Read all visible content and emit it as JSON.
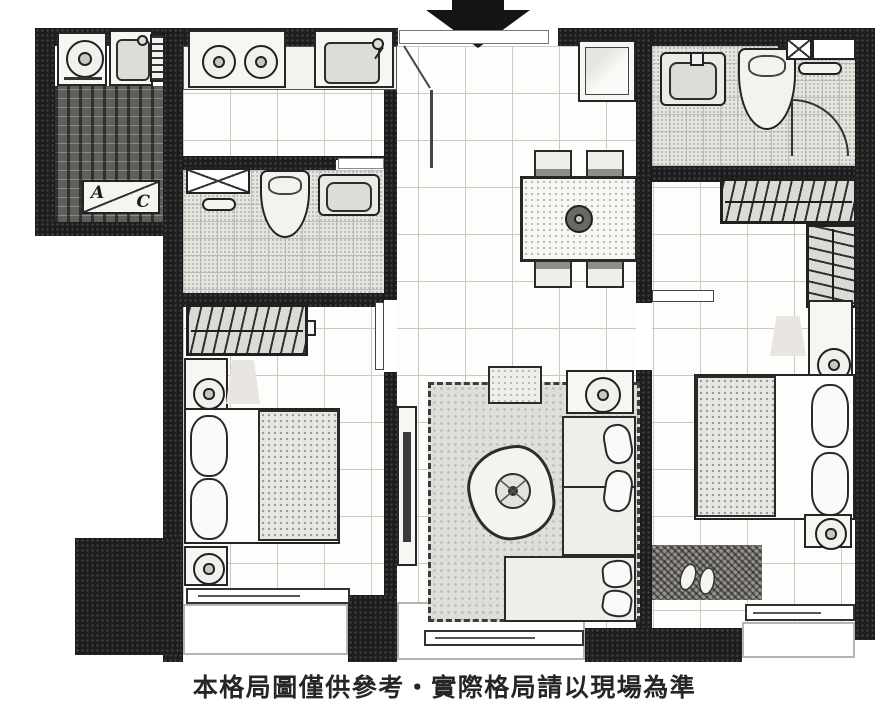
{
  "meta": {
    "type": "apartment-floor-plan",
    "disclaimer": "本格局圖僅供參考‧實際格局請以現場為準"
  },
  "labels": {
    "ac_a": "A",
    "ac_c": "C"
  },
  "entrance": {
    "marker": "arrow-down"
  },
  "colors": {
    "wall": "#1d1d1d",
    "floor_line": "#cbc9c4",
    "bath_tile": "#e6e4df",
    "dark_tile": "#605e5b",
    "furniture_fill": "#f7f6f3",
    "outline": "#262626"
  },
  "rooms": [
    "utility-porch",
    "ac-balcony",
    "kitchen",
    "entry-hall",
    "front-bathroom",
    "master-bathroom",
    "dining-area",
    "living-room",
    "left-bedroom",
    "right-bedroom",
    "left-balcony",
    "center-balcony",
    "right-balcony"
  ],
  "furniture": [
    "washing-machine",
    "utility-sink",
    "louver-rack",
    "gas-stove",
    "kitchen-sink",
    "refrigerator",
    "wash-basin-front",
    "toilet-front",
    "shower-door",
    "towel-shelf",
    "towel-bar",
    "bathtub-marker",
    "towel-ring",
    "toilet-master",
    "wash-basin-master",
    "dining-table",
    "dining-chairs",
    "table-centerpiece",
    "wardrobe-left",
    "wardrobe-right-l-shape",
    "double-bed-left",
    "double-bed-right",
    "pillows",
    "nightstands",
    "table-lamps",
    "tv-console",
    "television",
    "area-rug",
    "ottoman",
    "coffee-table",
    "potted-plant",
    "l-shaped-sofa",
    "side-table",
    "woven-mat",
    "slippers",
    "sliding-doors"
  ]
}
